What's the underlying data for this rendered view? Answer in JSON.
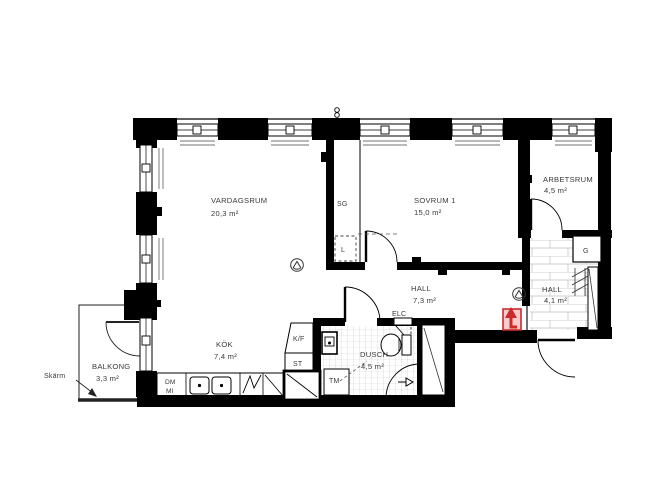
{
  "plan": {
    "kind": "apartment-floor-plan",
    "rooms": {
      "vardagsrum": {
        "name": "VARDAGSRUM",
        "area": "20,3 m²"
      },
      "sovrum1": {
        "name": "SOVRUM 1",
        "area": "15,0 m²"
      },
      "arbetsrum": {
        "name": "ARBETSRUM",
        "area": "4,5 m²"
      },
      "hall_inre": {
        "name": "HALL",
        "area": "7,3 m²"
      },
      "hall_entre": {
        "name": "HALL",
        "area": "4,1 m²"
      },
      "kok": {
        "name": "KÖK",
        "area": "7,4 m²"
      },
      "dusch": {
        "name": "DUSCH",
        "area": "4,5 m²"
      },
      "balkong": {
        "name": "BALKONG",
        "area": "3,3 m²"
      }
    },
    "closets": {
      "sg": "SG",
      "l": "L",
      "g": "G"
    },
    "appliances": {
      "kf": "K/F",
      "st": "ST",
      "tm": "TM",
      "dm": "DM",
      "mi": "MI"
    },
    "labels": {
      "elc": "ELC",
      "skarm": "Skärm"
    },
    "colors": {
      "wall": "#000000",
      "text": "#3a3a3a",
      "tile_line": "#c6c6c6",
      "entry_arrow": "#cc2a2a",
      "entry_arrow_fill": "#f7cbcb"
    }
  }
}
